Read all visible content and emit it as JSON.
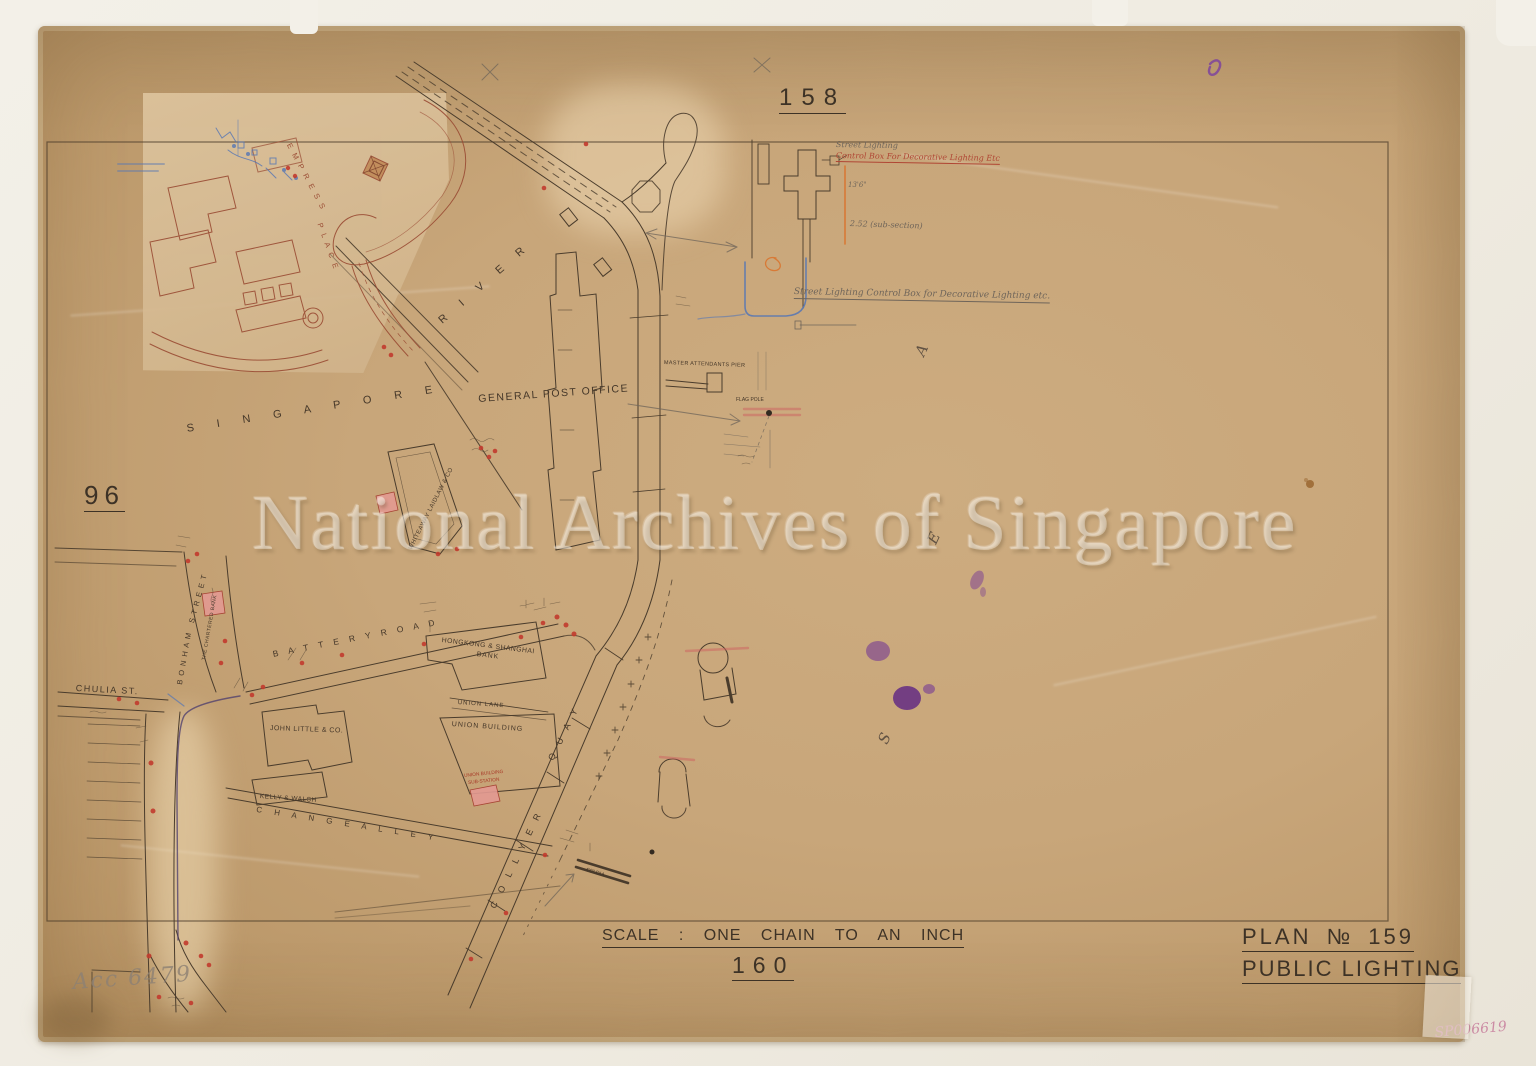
{
  "document": {
    "watermark": "National Archives of Singapore",
    "accession_note": "Acc 6479",
    "archive_ref": "SP006619",
    "scale_note": "SCALE : ONE CHAIN TO AN INCH",
    "title_block": {
      "plan_no": "PLAN № 159",
      "title": "PUBLIC LIGHTING"
    },
    "adjacent_plans": {
      "top": "158",
      "left": "96",
      "bottom": "160"
    }
  },
  "colors": {
    "paper": "#c8a67a",
    "ink": "#453729",
    "red_ink": "#a83a28",
    "inset_red": "#9a4c34",
    "pink_fill": "#e39a92",
    "blue_ink": "#5576b5",
    "orange_ink": "#d9742f",
    "pencil": "#6f655a",
    "purple_stain": "#6e2f96",
    "ref_pink": "#c9829f"
  },
  "map": {
    "labels": [
      {
        "id": "street-singapore",
        "text": "S   I   N   G   A   P   O   R   E",
        "x": 186,
        "y": 424,
        "size": 11,
        "rot": -9,
        "ls": 10,
        "cls": "ink"
      },
      {
        "id": "street-river",
        "text": "R  I  V  E  R",
        "x": 437,
        "y": 318,
        "size": 11,
        "rot": -41,
        "ls": 8,
        "cls": "ink"
      },
      {
        "id": "inset-street-empress",
        "text": "E M P R E S S",
        "x": 292,
        "y": 142,
        "size": 7.5,
        "rot": 62,
        "ls": 2,
        "cls": "redink"
      },
      {
        "id": "inset-street-place",
        "text": "P L A C E",
        "x": 323,
        "y": 222,
        "size": 7.5,
        "rot": 70,
        "ls": 2,
        "cls": "redink"
      },
      {
        "id": "street-bonham",
        "text": "B O N H A M",
        "x": 176,
        "y": 684,
        "size": 7.5,
        "rot": -80,
        "ls": 1,
        "cls": "ink"
      },
      {
        "id": "street-bonham-street",
        "text": "S T R E E T",
        "x": 188,
        "y": 622,
        "size": 7.5,
        "rot": -75,
        "ls": 1,
        "cls": "ink"
      },
      {
        "id": "street-chulia-st",
        "text": "CHULIA   ST.",
        "x": 76,
        "y": 684,
        "size": 9,
        "rot": 3,
        "ls": 1.5,
        "cls": "ink"
      },
      {
        "id": "street-battery-road",
        "text": "B A T T E R Y    R O A D",
        "x": 272,
        "y": 650,
        "size": 8.5,
        "rot": -11,
        "ls": 4,
        "cls": "ink"
      },
      {
        "id": "street-change-alley",
        "text": "C H A N G E      A L L E Y",
        "x": 257,
        "y": 806,
        "size": 8,
        "rot": 9,
        "ls": 5,
        "cls": "ink"
      },
      {
        "id": "street-collyer",
        "text": "C O L L Y E R",
        "x": 489,
        "y": 906,
        "size": 9,
        "rot": -64,
        "ls": 4,
        "cls": "ink"
      },
      {
        "id": "street-quay",
        "text": "Q U A Y",
        "x": 547,
        "y": 758,
        "size": 9,
        "rot": -64,
        "ls": 4,
        "cls": "ink"
      },
      {
        "id": "street-union-lane",
        "text": "UNION   LANE",
        "x": 458,
        "y": 700,
        "size": 6,
        "rot": 4,
        "ls": 1,
        "cls": "ink"
      },
      {
        "id": "bldg-general-post-office",
        "text": "GENERAL  POST  OFFICE",
        "x": 478,
        "y": 394,
        "size": 10.5,
        "rot": -4,
        "ls": 1.5,
        "cls": "ink"
      },
      {
        "id": "bldg-hsbc-line1",
        "text": "HONGKONG  &  SHANGHAI",
        "x": 442,
        "y": 638,
        "size": 6.8,
        "rot": 7,
        "ls": 0.5,
        "cls": "ink"
      },
      {
        "id": "bldg-hsbc-line2",
        "text": "BANK",
        "x": 477,
        "y": 652,
        "size": 6.8,
        "rot": 7,
        "ls": 1,
        "cls": "ink"
      },
      {
        "id": "bldg-union-building",
        "text": "UNION  BUILDING",
        "x": 452,
        "y": 721,
        "size": 7,
        "rot": 4,
        "ls": 1,
        "cls": "ink"
      },
      {
        "id": "bldg-john-little",
        "text": "JOHN  LITTLE  &  CO.",
        "x": 270,
        "y": 725,
        "size": 7,
        "rot": 2,
        "ls": 0.5,
        "cls": "ink"
      },
      {
        "id": "bldg-kelly-walsh",
        "text": "KELLY  &  WALSH",
        "x": 260,
        "y": 794,
        "size": 6.5,
        "rot": 4,
        "ls": 0.5,
        "cls": "ink"
      },
      {
        "id": "bldg-whiteaway-laidlaw",
        "text": "WHITEAWAY  LAIDLAW  &  CO",
        "x": 408,
        "y": 548,
        "size": 6,
        "rot": -63,
        "ls": 0.5,
        "cls": "ink"
      },
      {
        "id": "bldg-chartered-bank",
        "text": "THE  CHARTERED  BANK",
        "x": 202,
        "y": 660,
        "size": 5,
        "rot": -80,
        "ls": 0.5,
        "cls": "ink"
      },
      {
        "id": "bldg-substation-line1",
        "text": "UNION BUILDING",
        "x": 464,
        "y": 775,
        "size": 4.8,
        "rot": -6,
        "cls": "red"
      },
      {
        "id": "bldg-substation-line2",
        "text": "SUB-STATION",
        "x": 468,
        "y": 782,
        "size": 4.8,
        "rot": -6,
        "cls": "red"
      },
      {
        "id": "pier-master-attendants",
        "text": "MASTER  ATTENDANTS  PIER",
        "x": 664,
        "y": 361,
        "size": 5.5,
        "rot": 2,
        "ls": 0.3,
        "cls": "ink"
      },
      {
        "id": "flag-pole",
        "text": "FLAG  POLE",
        "x": 736,
        "y": 398,
        "size": 5,
        "rot": 0,
        "cls": "ink"
      },
      {
        "id": "note-street-lighting-line1",
        "text": "Street Lighting",
        "x": 836,
        "y": 141,
        "size": 8,
        "rot": 1,
        "cls": "pencil"
      },
      {
        "id": "note-street-lighting-line2",
        "text": "Control Box For Decorative Lighting Etc",
        "x": 836,
        "y": 152,
        "size": 8,
        "rot": 1,
        "cls": "redhand",
        "u": true
      },
      {
        "id": "note-dim-13ft6",
        "text": "13'6\"",
        "x": 848,
        "y": 182,
        "size": 7,
        "cls": "pencil"
      },
      {
        "id": "note-sub-section",
        "text": "2.52 (sub-section)",
        "x": 850,
        "y": 220,
        "size": 8,
        "rot": 2,
        "cls": "pencil"
      },
      {
        "id": "note-control-box",
        "text": "Street Lighting Control Box for Decorative Lighting etc.",
        "x": 794,
        "y": 288,
        "size": 9,
        "rot": 1,
        "cls": "pencil",
        "u": true
      },
      {
        "id": "sea-letter-a",
        "text": "A",
        "x": 913,
        "y": 352,
        "size": 15,
        "rot": -65,
        "cls": "sea"
      },
      {
        "id": "sea-letter-e",
        "text": "E",
        "x": 925,
        "y": 540,
        "size": 15,
        "rot": -65,
        "cls": "sea"
      },
      {
        "id": "sea-letter-s",
        "text": "S",
        "x": 876,
        "y": 740,
        "size": 15,
        "rot": -65,
        "cls": "sea"
      },
      {
        "id": "note-pipe-dia",
        "text": "4'0\" DIA",
        "x": 586,
        "y": 868,
        "size": 5.5,
        "rot": 17,
        "cls": "ink"
      }
    ]
  }
}
